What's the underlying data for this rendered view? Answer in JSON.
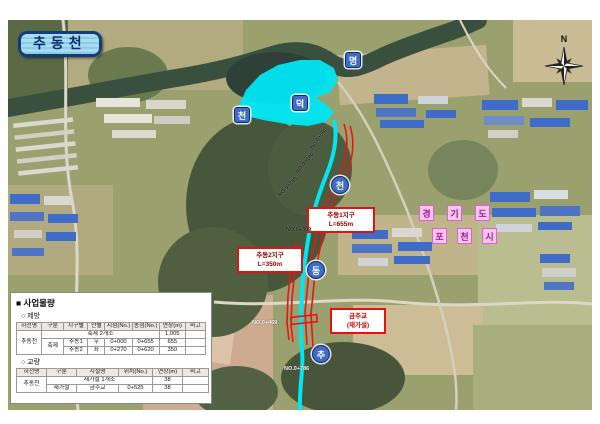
{
  "title": "추동천",
  "compass": {
    "n": "N"
  },
  "admin": {
    "chars": [
      "경",
      "기",
      "도",
      "포",
      "천",
      "시"
    ]
  },
  "stream_markers": [
    {
      "char": "명"
    },
    {
      "char": "덕"
    },
    {
      "char": "천"
    },
    {
      "char": "천"
    },
    {
      "char": "동"
    },
    {
      "char": "추"
    }
  ],
  "zones": [
    {
      "line1": "추동1지구",
      "line2": "L=655m"
    },
    {
      "line1": "추동2지구",
      "line2": "L=350m"
    },
    {
      "line1": "금주교",
      "line2": "(재가설)"
    }
  ],
  "chainage": [
    {
      "text": "NO.0+000"
    },
    {
      "text": "NO.0+100"
    },
    {
      "text": "NO.0+249"
    },
    {
      "text": "NO.0+309"
    },
    {
      "text": "NO.0+469"
    },
    {
      "text": "NO.0+786"
    }
  ],
  "panel": {
    "title": "■ 사업물량",
    "section1": "○ 제방",
    "table1": {
      "headers": [
        "하천명",
        "구분",
        "지구별",
        "안별",
        "시점(No.)",
        "종점(No.)",
        "연장(m)",
        "비고"
      ],
      "r1": {
        "river": "추동천",
        "summary": "축제 2개소",
        "total": "1,005"
      },
      "r2": {
        "gubun": "축제",
        "district": "추동1",
        "side": "우",
        "start": "0+000",
        "end": "0+655",
        "length": "655"
      },
      "r3": {
        "district": "추동2",
        "side": "좌",
        "start": "0+270",
        "end": "0+620",
        "length": "350"
      }
    },
    "section2": "○ 교량",
    "table2": {
      "headers": [
        "하천명",
        "구분",
        "시설명",
        "위치(No.)",
        "연장(m)",
        "비고"
      ],
      "r1": {
        "river": "추동천",
        "summary": "재가설 1개소",
        "length": "38"
      },
      "r2": {
        "gubun": "재가설",
        "name": "금주교",
        "position": "0+525",
        "length": "38"
      }
    }
  },
  "colors": {
    "improvement_line_red": "#e51717",
    "highlight_water_cyan": "#00e6f2",
    "marker_blue": "#3f6cc8",
    "admin_label_pink": "#f7c6ea",
    "title_navy": "#0a2f6e"
  }
}
